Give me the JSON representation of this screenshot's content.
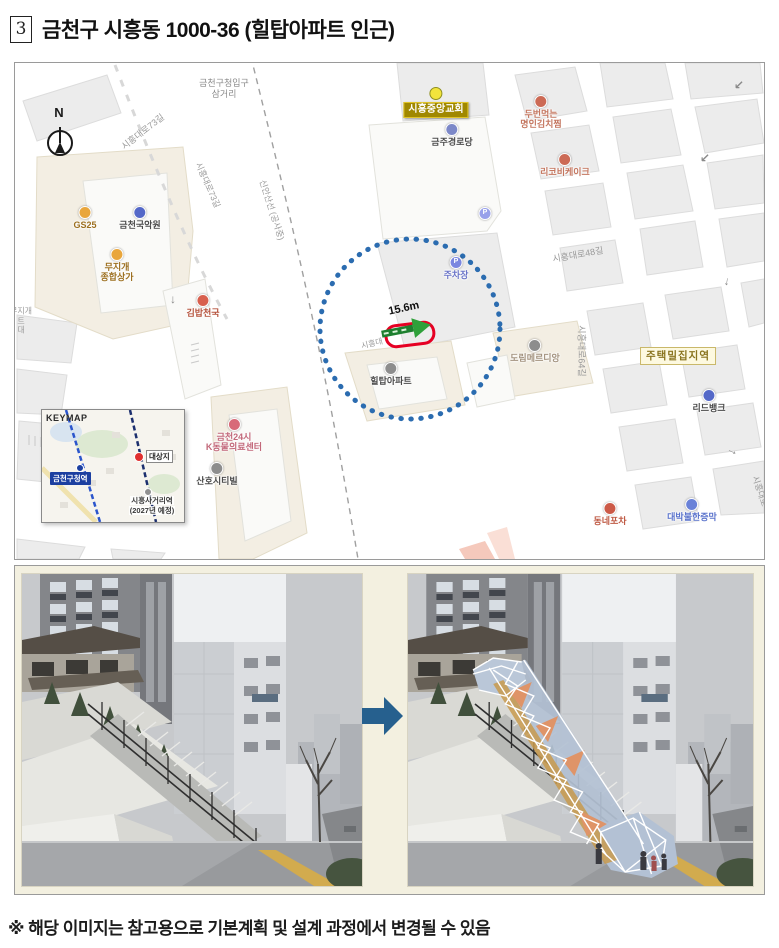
{
  "page": {
    "title_number": "3",
    "title": "금천구 시흥동 1000-36 (힐탑아파트 인근)",
    "footnote": "※ 해당 이미지는 참고용으로 기본계획 및 설계 과정에서 변경될 수 있음"
  },
  "map": {
    "distance_label": "15.6m",
    "colors": {
      "radius_circle_blue": "#2b6cb0",
      "site_outline_red": "#e60023",
      "distance_arrow_green": "#2fa03a",
      "church_box_bg": "#a08800",
      "area_box_text": "#8a7520",
      "keymap_station_bg": "#1c3fa0",
      "transform_arrow_blue": "#26608e"
    },
    "keymap": {
      "title": "KEYMAP",
      "station1": "금천구청역",
      "site_label": "대상지",
      "station2_line1": "시흥사거리역",
      "station2_line2": "(2027년 예정)"
    },
    "road_labels": [
      {
        "text": "N",
        "x": 44,
        "y": 50,
        "rot": 0,
        "size": 13,
        "color": "#1a1a1a",
        "bold": true
      },
      {
        "text": "시흥대로73길",
        "x": 128,
        "y": 69,
        "rot": -38,
        "size": 9
      },
      {
        "text": "금천구청입구\n삼거리",
        "x": 209,
        "y": 26,
        "rot": 0,
        "size": 9,
        "color": "#8a8a8a"
      },
      {
        "text": "시흥대로73길",
        "x": 193,
        "y": 122,
        "rot": 66,
        "size": 8.5
      },
      {
        "text": "신안산선 (공사중)",
        "x": 257,
        "y": 147,
        "rot": 72,
        "size": 8.5
      },
      {
        "text": "시흥대",
        "x": 357,
        "y": 281,
        "rot": -14,
        "size": 8
      },
      {
        "text": "15.6m",
        "x": 389,
        "y": 246,
        "rot": -12,
        "size": 11,
        "color": "#111",
        "bold": true
      },
      {
        "text": "시흥대로48길",
        "x": 563,
        "y": 192,
        "rot": -10,
        "size": 9
      },
      {
        "text": "시흥대로64길",
        "x": 566,
        "y": 288,
        "rot": 90,
        "size": 9
      },
      {
        "text": "시흥대로",
        "x": 745,
        "y": 428,
        "rot": 72,
        "size": 8.5
      },
      {
        "text": "무지개\n트\n대",
        "x": 6,
        "y": 258,
        "rot": 0,
        "size": 8,
        "color": "#9a9a9a"
      }
    ],
    "arrows": [
      {
        "glyph": "↓",
        "x": 158,
        "y": 236,
        "rot": 0
      },
      {
        "glyph": "↙",
        "x": 690,
        "y": 95,
        "rot": 0
      },
      {
        "glyph": "↙",
        "x": 724,
        "y": 22,
        "rot": 0
      },
      {
        "glyph": "↓",
        "x": 712,
        "y": 218,
        "rot": 10
      },
      {
        "glyph": "→",
        "x": 718,
        "y": 387,
        "rot": 25
      }
    ],
    "pois": [
      {
        "label": "GS25",
        "x": 70,
        "y": 150,
        "type": "dot",
        "dot": "#e9a63c",
        "color": "#9c6f1f"
      },
      {
        "label": "금천국악원",
        "x": 125,
        "y": 150,
        "type": "dot",
        "dot": "#5468c8",
        "color": "#4a4a4a"
      },
      {
        "label": "무지개\n종합상가",
        "x": 102,
        "y": 192,
        "type": "dot",
        "dot": "#e9a63c",
        "color": "#9c6f1f"
      },
      {
        "label": "김밥천국",
        "x": 188,
        "y": 238,
        "type": "dot",
        "dot": "#d8604e",
        "color": "#b5523c"
      },
      {
        "label": "시흥중앙교회",
        "x": 421,
        "y": 31,
        "type": "church"
      },
      {
        "label": "금주경로당",
        "x": 437,
        "y": 67,
        "type": "dot",
        "dot": "#7c88c8",
        "color": "#4a4a4a"
      },
      {
        "label": "두번먹는\n명인김치찜",
        "x": 526,
        "y": 39,
        "type": "dot",
        "dot": "#cc6a55",
        "color": "#c4765f"
      },
      {
        "label": "리코비케이크",
        "x": 550,
        "y": 97,
        "type": "dot",
        "dot": "#cc6a55",
        "color": "#c4765f"
      },
      {
        "label": "",
        "x": 470,
        "y": 151,
        "type": "dot",
        "dot": "#98a0ea",
        "glyph": "P"
      },
      {
        "label": "주차장",
        "x": 441,
        "y": 200,
        "type": "dot",
        "dot": "#7b87e0",
        "glyph": "P",
        "color": "#6a74c8"
      },
      {
        "label": "도림메르디앙",
        "x": 520,
        "y": 283,
        "type": "dot",
        "dot": "#8d8d8d",
        "color": "#a3937f"
      },
      {
        "label": "힐탑아파트",
        "x": 376,
        "y": 306,
        "type": "dot",
        "dot": "#8d8d8d",
        "color": "#4a4a4a"
      },
      {
        "label": "주택밀집지역",
        "x": 663,
        "y": 291,
        "type": "area"
      },
      {
        "label": "리드뱅크",
        "x": 694,
        "y": 333,
        "type": "dot",
        "dot": "#5468c8",
        "color": "#4a4a4a"
      },
      {
        "label": "동네포차",
        "x": 595,
        "y": 446,
        "type": "dot",
        "dot": "#cc5a48",
        "color": "#bf5a44"
      },
      {
        "label": "대박불한증막",
        "x": 677,
        "y": 442,
        "type": "dot",
        "dot": "#6a82d8",
        "color": "#5b74cc"
      },
      {
        "label": "금천24시\nK동물의료센터",
        "x": 219,
        "y": 362,
        "type": "dot",
        "dot": "#d86a78",
        "color": "#c2687a"
      },
      {
        "label": "산호시티빌",
        "x": 202,
        "y": 406,
        "type": "dot",
        "dot": "#8d8d8d",
        "color": "#4a4a4a"
      }
    ]
  }
}
